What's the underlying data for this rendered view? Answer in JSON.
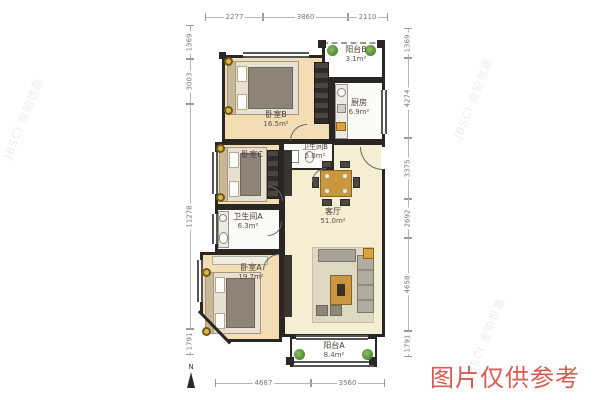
{
  "rooms": {
    "balcony_b": {
      "name": "阳台B",
      "area": "3.1m²"
    },
    "kitchen": {
      "name": "厨房",
      "area": "6.9m²"
    },
    "bedroom_b": {
      "name": "卧室B",
      "area": "16.5m²"
    },
    "bath_b": {
      "name": "卫生间B",
      "area": "5.0m²"
    },
    "bedroom_c": {
      "name": "卧室C",
      "area": ""
    },
    "bath_a": {
      "name": "卫生间A",
      "area": "6.3m²"
    },
    "living": {
      "name": "客厅",
      "area": "51.0m²"
    },
    "bedroom_a": {
      "name": "卧室A",
      "area": "19.7m²"
    },
    "balcony_a": {
      "name": "阳台A",
      "area": "8.4m²"
    }
  },
  "dims": {
    "top": [
      "2277",
      "3860",
      "2110"
    ],
    "bottom": [
      "4687",
      "3560"
    ],
    "left": [
      "1369",
      "3003",
      "11278",
      "1791"
    ],
    "right": [
      "1369",
      "4274",
      "3375",
      "2692",
      "4658",
      "1791"
    ]
  },
  "compass": {
    "label": "N"
  },
  "watermarks": {
    "notice": "图片仅供参考",
    "brand": "JBSCI 金铂世嘉"
  },
  "colors": {
    "wall": "#2a2624",
    "bedroom_floor": "#f2ddb5",
    "living_floor": "#f6eed3",
    "white_room": "#fafaf7",
    "plant_green": "#4c8a38",
    "notice_red": "#d85a52",
    "dim_text": "#777777"
  }
}
